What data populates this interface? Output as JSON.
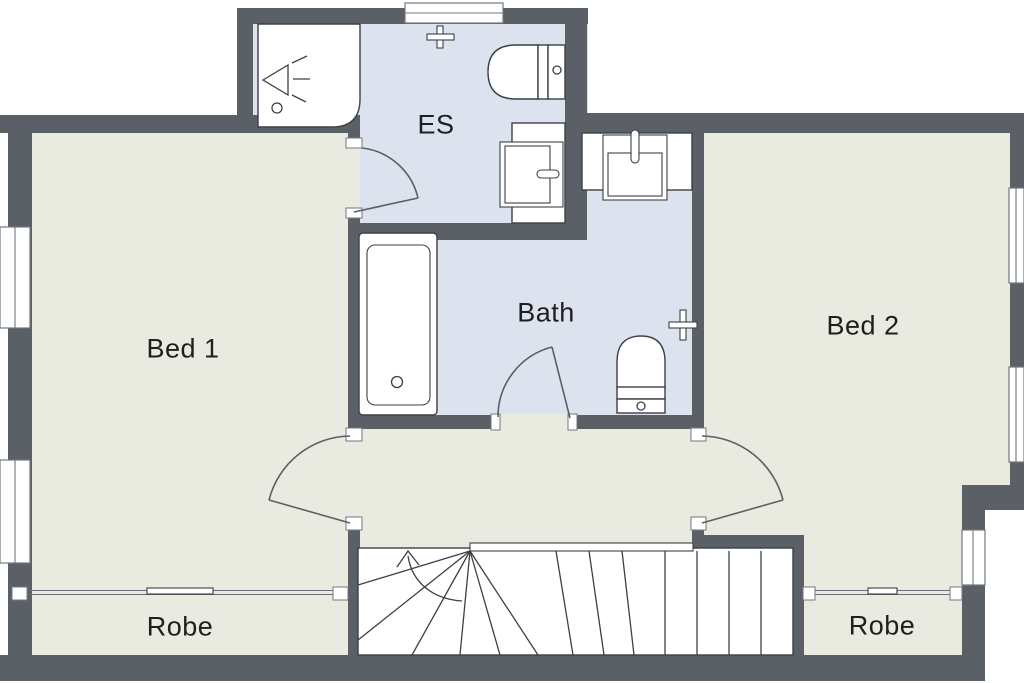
{
  "rooms": {
    "bed1": {
      "label": "Bed 1"
    },
    "bed2": {
      "label": "Bed 2"
    },
    "ensuite": {
      "label": "ES"
    },
    "bath": {
      "label": "Bath"
    },
    "robe_left": {
      "label": "Robe"
    },
    "robe_right": {
      "label": "Robe"
    }
  },
  "fixtures": [
    "shower",
    "toilet",
    "vanity-basin",
    "towel-rail",
    "bathtub",
    "vanity-basin",
    "toilet",
    "towel-rail",
    "stairs-up-arrow",
    "sliding-robe-doors",
    "hinged-doors",
    "windows"
  ],
  "colors": {
    "wall": "#5b6066",
    "floor": "#e9eae0",
    "wet_floor": "#dce3ef",
    "fixture": "#ffffff",
    "line": "#3c4046",
    "label": "#1f1f1f",
    "window_line": "#73787f"
  }
}
